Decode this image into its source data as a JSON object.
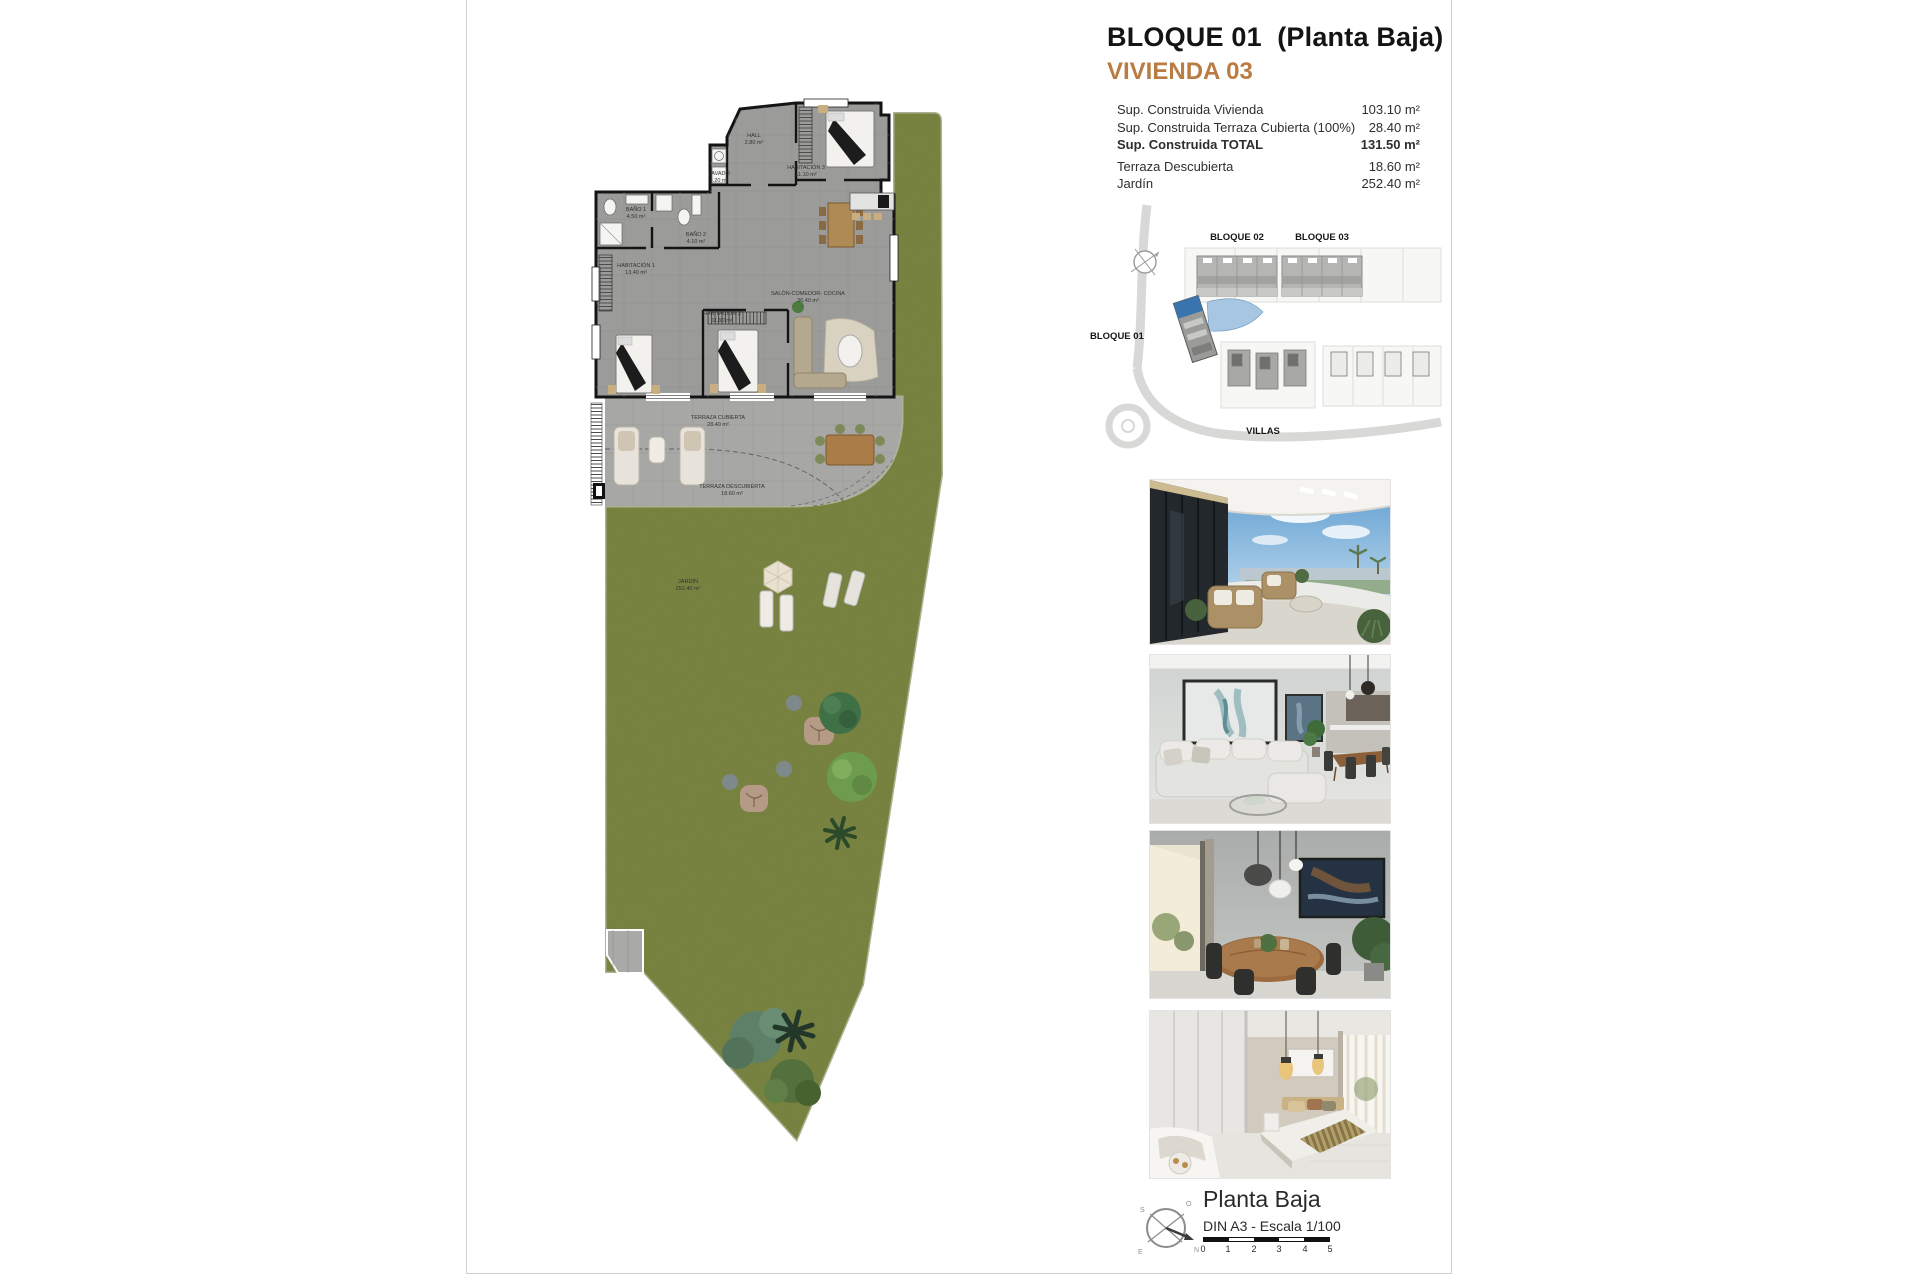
{
  "palette": {
    "accent_orange": "#b97c43",
    "highlight_blue": "#3a74ae",
    "garden_green": "#98a15c",
    "floor_gray": "#9b9b99"
  },
  "header": {
    "title": "BLOQUE 01  (Planta Baja)",
    "subtitle": "VIVIENDA 03"
  },
  "specs": {
    "rows": [
      {
        "label": "Sup. Construida Vivienda",
        "value": "103.10 m²"
      },
      {
        "label": "Sup. Construida Terraza Cubierta (100%)",
        "value": "28.40 m²"
      },
      {
        "label": "Sup. Construida TOTAL",
        "value": "131.50 m²"
      },
      {
        "label": "Terraza Descubierta",
        "value": "18.60 m²"
      },
      {
        "label": "Jardín",
        "value": "252.40 m²"
      }
    ]
  },
  "site_plan": {
    "bloque01": "BLOQUE 01",
    "bloque02": "BLOQUE 02",
    "bloque03": "BLOQUE 03",
    "villas": "VILLAS"
  },
  "floor_plan": {
    "rooms": [
      {
        "name": "HALL",
        "area": "2.80 m²"
      },
      {
        "name": "LAVADO",
        "area": "3.20 m²"
      },
      {
        "name": "HABITACIÓN 3",
        "area": "11.10 m²"
      },
      {
        "name": "BAÑO 1",
        "area": "4.50 m²"
      },
      {
        "name": "BAÑO 2",
        "area": "4.10 m²"
      },
      {
        "name": "HABITACIÓN 1",
        "area": "13.40 m²"
      },
      {
        "name": "HABITACIÓN 2",
        "area": "11.90 m²"
      },
      {
        "name": "SALÓN-COMEDOR- COCINA",
        "area": "36.40 m²"
      },
      {
        "name": "TERRAZA CUBIERTA",
        "area": "28.40 m²"
      },
      {
        "name": "TERRAZA DESCUBIERTA",
        "area": "18.60 m²"
      },
      {
        "name": "JARDÍN",
        "area": "252.40 m²"
      }
    ]
  },
  "photos": [
    {
      "name": "terrace-exterior"
    },
    {
      "name": "living-room"
    },
    {
      "name": "dining-room"
    },
    {
      "name": "bedroom"
    }
  ],
  "footer": {
    "title": "Planta Baja",
    "scale_note": "DIN A3 - Escala 1/100",
    "ticks": [
      "0",
      "1",
      "2",
      "3",
      "4",
      "5"
    ],
    "compass_letters": [
      "S",
      "O",
      "E",
      "N"
    ]
  }
}
